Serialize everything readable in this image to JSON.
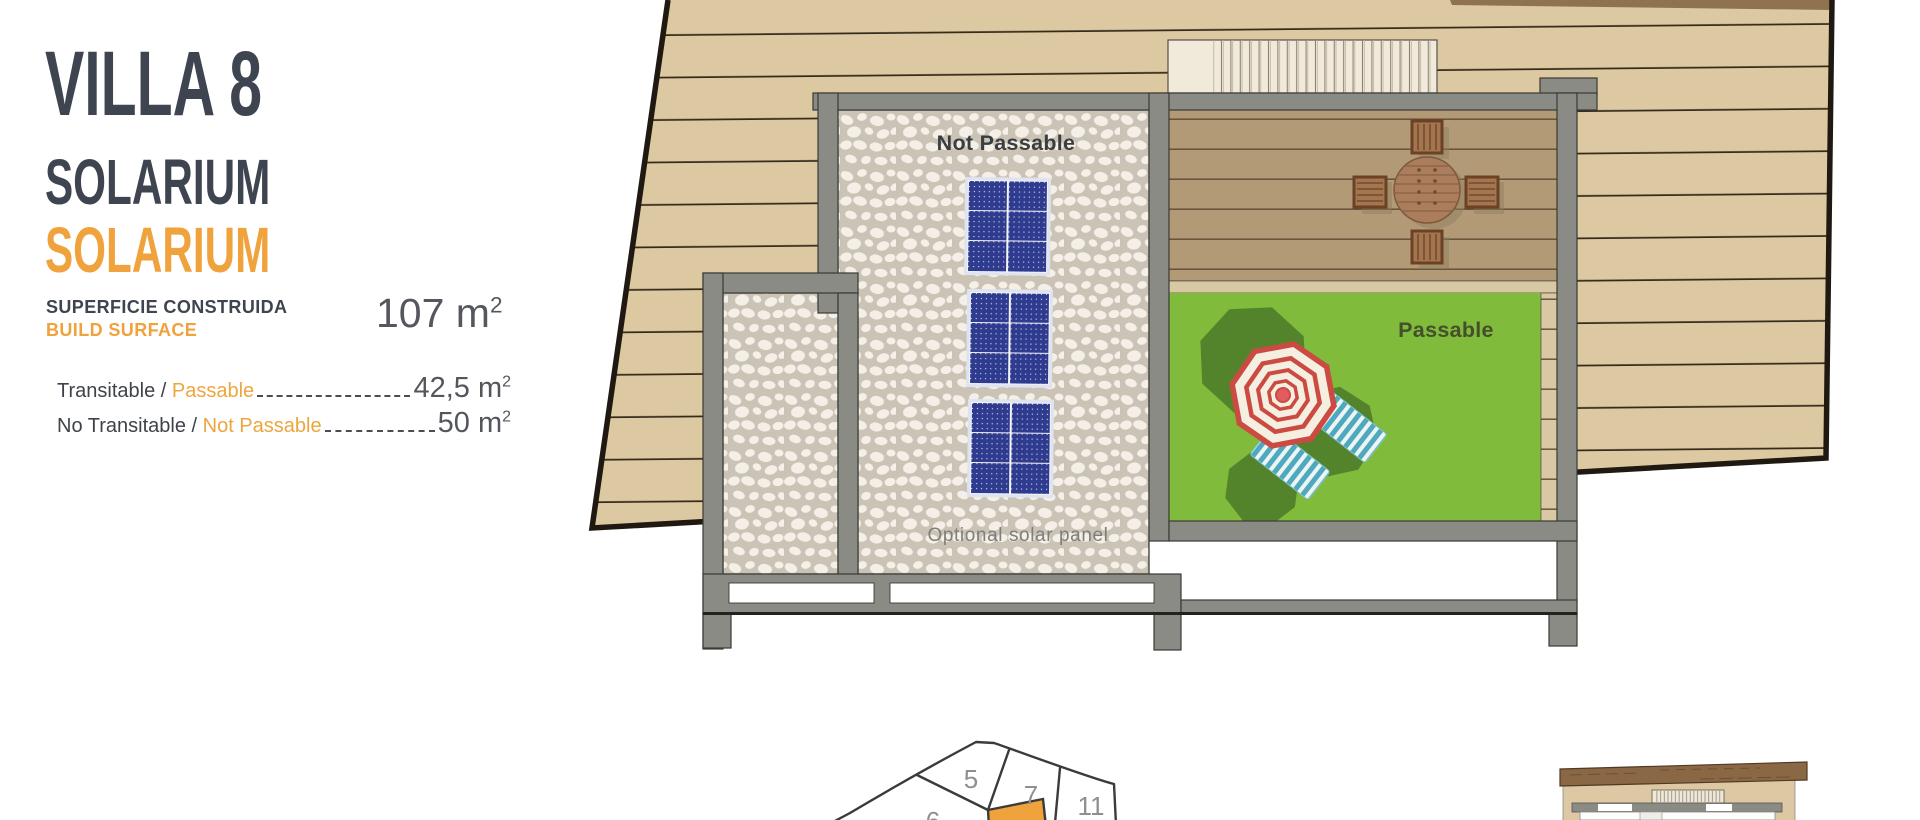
{
  "panel": {
    "title": "VILLA 8",
    "subtitle_primary": "SOLARIUM",
    "subtitle_secondary": "SOLARIUM",
    "surface_label_es": "SUPERFICIE CONSTRUIDA",
    "surface_label_en": "BUILD SURFACE",
    "surface_value": "107 m",
    "surface_sup": "2",
    "metrics": [
      {
        "label_es": "Transitable / ",
        "label_en": "Passable",
        "value": "42,5 m",
        "sup": "2"
      },
      {
        "label_es": "No Transitable / ",
        "label_en": "Not Passable",
        "value": "50 m",
        "sup": "2"
      }
    ]
  },
  "plan": {
    "not_passable_label": "Not Passable",
    "passable_label": "Passable",
    "optional_solar_label": "Optional solar panel"
  },
  "site_map": {
    "plot_5": "5",
    "plot_6": "6",
    "plot_7": "7",
    "plot_11": "11"
  },
  "colors": {
    "accent_orange": "#F0A23C",
    "title_dark": "#3E4450",
    "wood_background": "#DDC9A1",
    "deck_wood": "#B29A76",
    "lawn_green": "#80BB3B",
    "wall_gray": "#8B8B85",
    "solar_panel_blue": "#2F3B8E",
    "umbrella_red": "#CB4B43"
  }
}
